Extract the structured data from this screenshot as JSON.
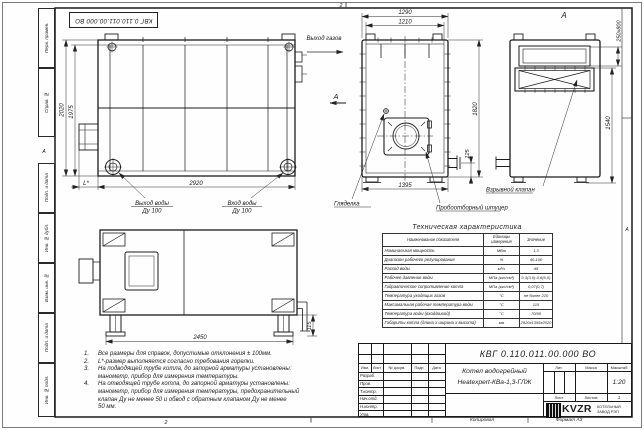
{
  "stamp_inverted": "КВГ 0.110.011.00.000 ВО",
  "frame": {
    "left_labels": [
      "Перв. примен.",
      "Справ. №",
      "Подп. и дата",
      "Инв. № дубл.",
      "Взам. инв. №",
      "Подп. и дата",
      "Инв. № подл."
    ],
    "zone_top": "2",
    "zone_bottom": "2",
    "zone_left": "А",
    "zone_right": "А"
  },
  "plan_view": {
    "dim_height": "2020",
    "dim_height_inner": "1975",
    "dim_width": "2920",
    "dim_l": "L*",
    "label_gas_out": "Выход газов",
    "label_water_out_1": "Выход воды",
    "label_water_out_2": "Ду 100",
    "label_water_in_1": "Вход воды",
    "label_water_in_2": "Ду 100"
  },
  "front_view": {
    "dim_w1": "1290",
    "dim_w2": "1210",
    "dim_h": "1820",
    "dim_h2": "125",
    "dim_w3": "1395",
    "section_letter": "А",
    "label_sight": "Гляделка",
    "label_sampling": "Пробоотборный штуцер"
  },
  "side_view": {
    "view_letter": "А",
    "dim_vent": "250x800",
    "dim_h": "1540",
    "label_valve": "Взрывной клапан"
  },
  "bottom_view": {
    "dim_w": "2450",
    "dim_h": "115"
  },
  "notes": [
    {
      "num": "1.",
      "lines": [
        "Все размеры для справок, допустимые отклонения ± 100мм."
      ]
    },
    {
      "num": "2.",
      "lines": [
        "L*-размер выполняется согласно требования горелки."
      ]
    },
    {
      "num": "3.",
      "lines": [
        "На подводящей трубе котла, до запорной арматуры установлены:",
        "манометр, прибор для измерения температуры."
      ]
    },
    {
      "num": "4.",
      "lines": [
        "На отводящей трубе котла, до запорной арматуры установлены:",
        "манометр, прибор для измерения температуры, предохранительный",
        "клапан Ду не менее 50 и обвод с обратным клапаном Ду не менее",
        "50 мм."
      ]
    }
  ],
  "spec_table": {
    "title": "Техническая характеристика",
    "col_name": "Наименование показателя",
    "col_unit": "Единицы измерения",
    "col_value": "Значение",
    "rows": [
      {
        "name": "Номинальная мощность",
        "unit": "МВт",
        "value": "1,3"
      },
      {
        "name": "Диапазон рабочего регулирования",
        "unit": "%",
        "value": "40-100"
      },
      {
        "name": "Расход воды",
        "unit": "м³/ч",
        "value": "45"
      },
      {
        "name": "Рабочее давление воды",
        "unit": "МПа (кгс/см²)",
        "value": "0,3(3,0)-0,6(6,0)"
      },
      {
        "name": "Гидравлическое сопротивление котла",
        "unit": "МПа (кгс/см²)",
        "value": "0,07(0,7)"
      },
      {
        "name": "Температура уходящих газов",
        "unit": "°С",
        "value": "не более 220"
      },
      {
        "name": "Максимальная рабочая температура воды",
        "unit": "°С",
        "value": "115"
      },
      {
        "name": "Температура воды (вход/выход)",
        "unit": "°С",
        "value": "70/95"
      },
      {
        "name": "Габариты котла (длина х ширина х высота)",
        "unit": "мм",
        "value": "2920х1395х2020"
      }
    ]
  },
  "title_block": {
    "doc_number": "КВГ 0.110.011.00.000 ВО",
    "product_line1": "Котел водогрейный",
    "product_line2": "Heatexpert-КВа-1,3-ГЛЖ",
    "header_cols": [
      "Изм.",
      "Лист",
      "№ докум.",
      "Подп.",
      "Дата"
    ],
    "role_rows": [
      "Разраб.",
      "Пров.",
      "Т.контр.",
      "Нач.отд.",
      "Н.контр.",
      "Утв."
    ],
    "lit_label": "Лит.",
    "mass_label": "Масса",
    "scale_label": "Масштаб",
    "scale_value": "1:20",
    "sheet_label": "Лист",
    "sheets_label": "Листов",
    "sheets_value": "1",
    "logo_text": "KVZR",
    "company_line1": "КОТЕЛЬНЫЙ",
    "company_line2": "ЗАВОД РЭП",
    "copied_label": "Копировал",
    "format_label": "Формат А3"
  }
}
